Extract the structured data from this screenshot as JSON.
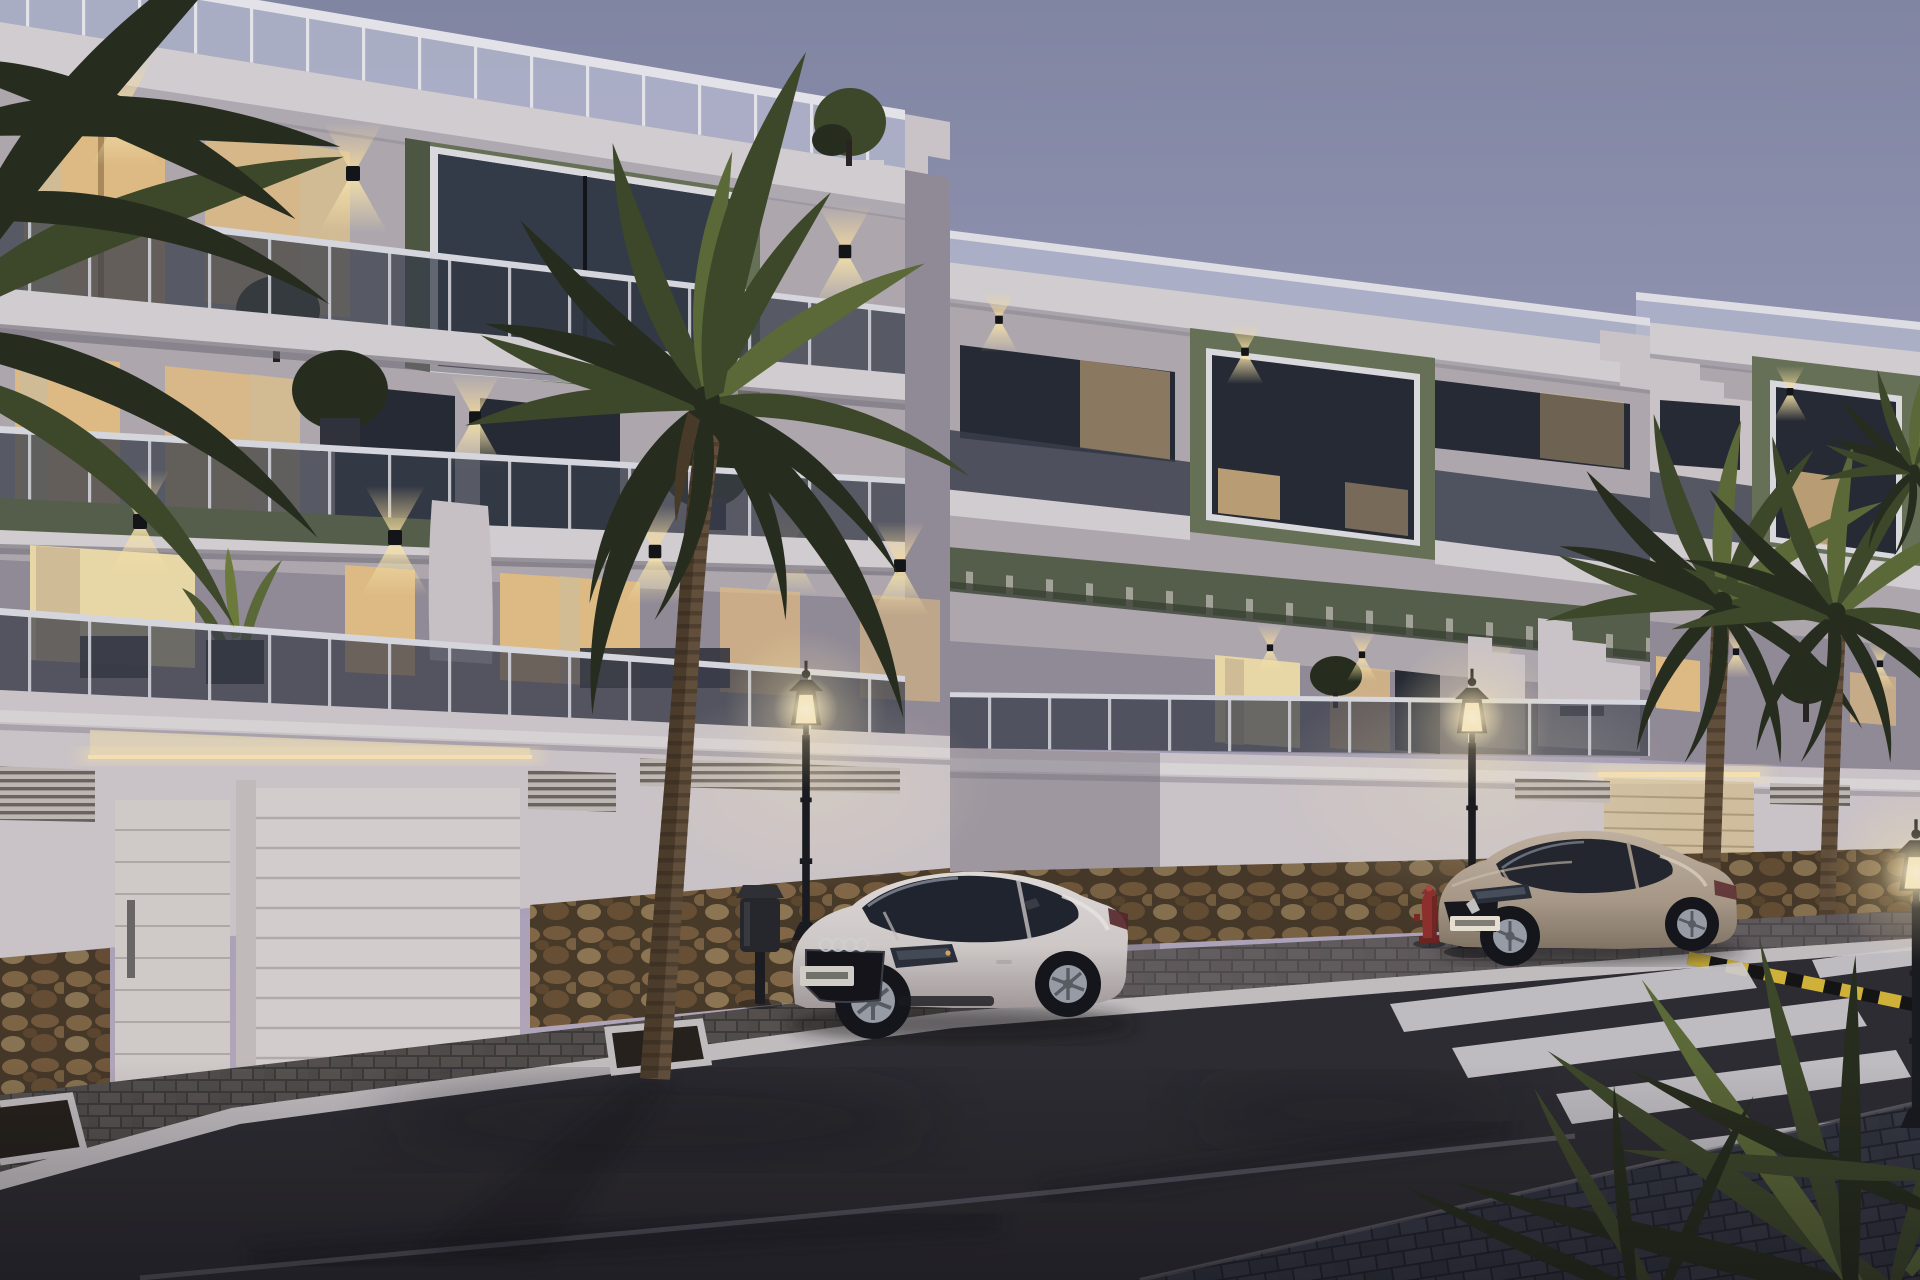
{
  "scene": {
    "kind": "architectural-3d-render",
    "time_of_day": "dusk",
    "setting": "modern Mediterranean apartment complex street view with parked cars and palm trees",
    "text_visible": "none",
    "objects": {
      "buildings": [
        "apartment-building-left",
        "apartment-building-middle",
        "apartment-building-right"
      ],
      "building_features": [
        "rooftop-glass-railing",
        "olive-green-accent-volumes",
        "smoked-glass-balconies",
        "stepped-cornices",
        "up-down-wall-lights",
        "warm-lit-windows-with-curtains",
        "green-pergola",
        "garage-doors-with-led-strip",
        "ventilation-grilles",
        "rustic-stone-base",
        "rooftop-plants",
        "terrace-plants"
      ],
      "vehicles": [
        "white-coupe-parked",
        "beige-coupe-parked"
      ],
      "street": [
        "asphalt-road",
        "paved-sidewalk",
        "white-curbs",
        "zebra-crosswalk",
        "yellow-black-curb-marking",
        "road-lane-line",
        "palm-tree-pits"
      ],
      "street_furniture": [
        "street-lamp-left",
        "street-lamp-right",
        "street-lamp-far-right",
        "trash-bin",
        "fire-hydrant"
      ],
      "vegetation": [
        "large-foreground-palm",
        "left-edge-palm-fronds",
        "twin-palms-right",
        "distant-palm",
        "foreground-frond-cluster",
        "potted-agave",
        "balcony-trees"
      ]
    },
    "counts": {
      "cars": 2,
      "lit_street_lamps": 3,
      "crosswalk_stripes": 5,
      "garage_doors": 3,
      "building_blocks": 3
    }
  },
  "palette": {
    "sky_top": "#858BA8",
    "sky_mid": "#A0A0BE",
    "sky_low": "#B3A8BF",
    "sky_horizon": "#C2B1C1",
    "fascia": "#DAD5D7",
    "wall_lit": "#D2CBCE",
    "wall_mid": "#B5AEB4",
    "wall_shadow": "#968F9B",
    "wall_dark": "#7E7886",
    "wall_warm": "#E8DABC",
    "green_accent": "#6A7458",
    "green_dark": "#4F5944",
    "green_slab": "#57614C",
    "glass_dark": "#3A3F4C",
    "glass_roof": "#B7BCD2",
    "window_warm": "#E7C288",
    "window_bright": "#F2E0AC",
    "window_dark": "#262B35",
    "curtain": "#D9C49C",
    "stone_mortar": "#54432F",
    "stone_1": "#9A7C54",
    "stone_2": "#8A6B47",
    "stone_3": "#A88D63",
    "stone_4": "#7B5F3E",
    "pave": "#57524F",
    "pave_gap": "#3F3B3A",
    "pave_blue": "#434A55",
    "curb": "#C9C4C6",
    "road": "#2E2D32",
    "road_dark": "#1F1E23",
    "road_line": "#8B8894",
    "zebra": "#D6D2D6",
    "hazard_yellow": "#D8B93A",
    "palm_dark": "#272E1D",
    "palm_mid": "#3F4A2A",
    "palm_light": "#5E6C38",
    "agave": "#6F7F3C",
    "trunk": "#65523D",
    "trunk_band": "#3F3222",
    "lamp_black": "#1A1B1F",
    "glow_core": "#FFF6D8",
    "glow_warm": "#FFE9B0",
    "led": "#FFE9B8",
    "car_white": "#DCD7D4",
    "car_white_shade": "#A89F9F",
    "car_beige": "#B4A492",
    "car_beige_shade": "#8A7D6C",
    "tire": "#15161A",
    "rim": "#9CA2AB",
    "hydrant": "#93312D"
  }
}
